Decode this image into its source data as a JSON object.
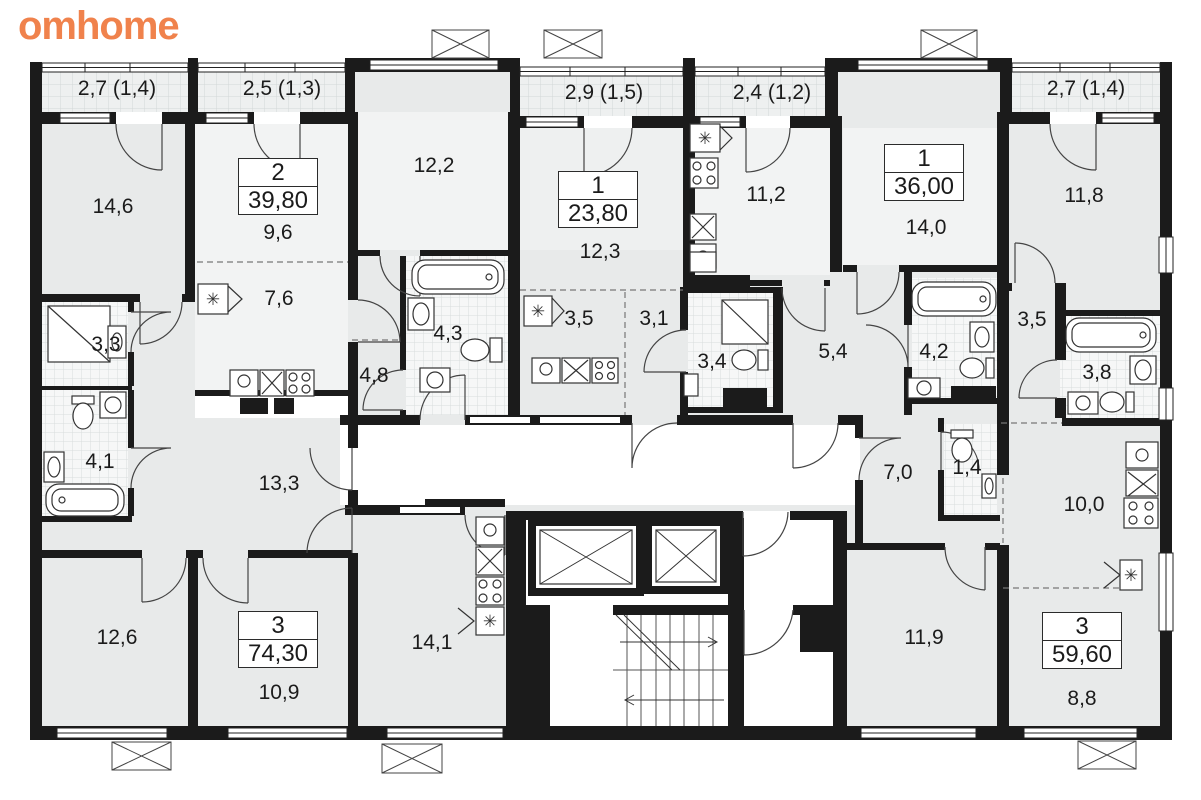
{
  "brand": {
    "logo": "omhome"
  },
  "colors": {
    "accent_orange": "#f0824c",
    "wall": "#1b1b1b",
    "room_fill": "#e8eaea",
    "room_fill_light": "#f2f3f3",
    "corridor": "#ffffff"
  },
  "symbols": {
    "fridge": "✳"
  },
  "floorplan": {
    "balconies": [
      {
        "label": "2,7 (1,4)"
      },
      {
        "label": "2,5 (1,3)"
      },
      {
        "label": "2,9 (1,5)"
      },
      {
        "label": "2,4 (1,2)"
      },
      {
        "label": "2,7 (1,4)"
      }
    ],
    "apartments": [
      {
        "rooms": "2",
        "area": "39,80"
      },
      {
        "rooms": "1",
        "area": "23,80"
      },
      {
        "rooms": "1",
        "area": "36,00"
      },
      {
        "rooms": "3",
        "area": "74,30"
      },
      {
        "rooms": "3",
        "area": "59,60"
      }
    ],
    "room_labels": [
      {
        "label": "14,6"
      },
      {
        "label": "9,6"
      },
      {
        "label": "7,6"
      },
      {
        "label": "12,2"
      },
      {
        "label": "12,3"
      },
      {
        "label": "11,2"
      },
      {
        "label": "14,0"
      },
      {
        "label": "11,8"
      },
      {
        "label": "3,3"
      },
      {
        "label": "4,1"
      },
      {
        "label": "13,3"
      },
      {
        "label": "4,8"
      },
      {
        "label": "4,3"
      },
      {
        "label": "3,5"
      },
      {
        "label": "3,1"
      },
      {
        "label": "3,4"
      },
      {
        "label": "5,4"
      },
      {
        "label": "4,2"
      },
      {
        "label": "3,5"
      },
      {
        "label": "3,8"
      },
      {
        "label": "7,0"
      },
      {
        "label": "1,4"
      },
      {
        "label": "10,0"
      },
      {
        "label": "12,6"
      },
      {
        "label": "10,9"
      },
      {
        "label": "14,1"
      },
      {
        "label": "11,9"
      },
      {
        "label": "8,8"
      }
    ]
  }
}
